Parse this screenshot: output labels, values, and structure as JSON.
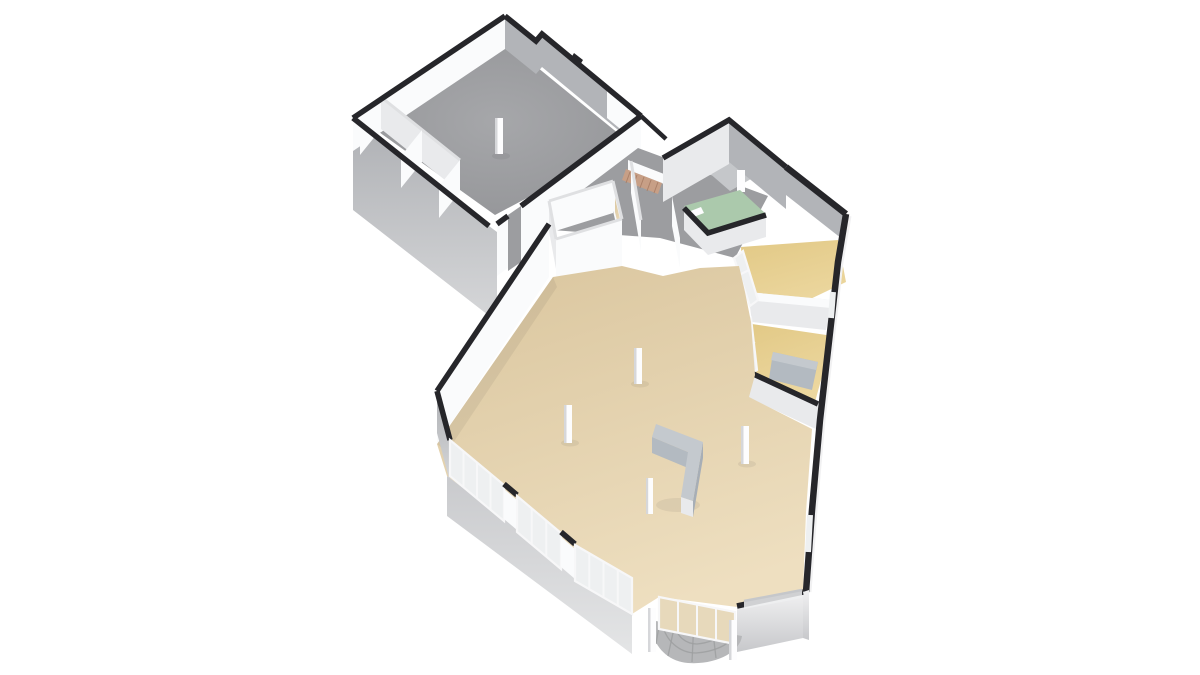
{
  "meta": {
    "kind": "3d-floorplan-render",
    "view": "isometric-birdseye",
    "background": "#ffffff",
    "visible_text": ""
  },
  "colors": {
    "bg": "#ffffff",
    "wallCap": "#26262a",
    "capLight": "#dfe0e2",
    "frame": "#f7f7f8",
    "wallFaceLit": "#fafbfc",
    "wallFaceSoft": "#e9eaec",
    "wallFaceMid": "#c5c7ca",
    "wallFaceShadow": "#b2b4b8",
    "floorGray": "#9c9da0",
    "floorGrayLight": "#a6a7aa",
    "floorGrayDark": "#919295",
    "floorBeigeLight": "#eedfc0",
    "floorBeigeDark": "#dbc7a0",
    "floorGoldLight": "#ecd79f",
    "floorGoldDark": "#e2c986",
    "floorGreen": "#abc9ac",
    "glass": "#eef0f1",
    "glassTint": "#e7d9bb",
    "extTop": "#aeb0b4",
    "extBottom": "#d6d7d9",
    "extWhiteTop": "#f1f1f2",
    "extWhiteBottom": "#c7c8cb",
    "slabTop": "#c9cacd",
    "slabBottom": "#e4e5e6",
    "porchTile": "#b6b7b9",
    "porchGrout": "#9c9d9f",
    "stairSalmon": "#c79f86",
    "stairTread": "#ab8169",
    "counterTop": "#c4c9ce",
    "counterSide": "#a7aeb6",
    "counterSide2": "#b3bac1",
    "columnWhite": "#fdfdfe",
    "columnShade": "#d6d7da"
  },
  "scene": {
    "building": "single-storey commercial unit, 3D dollhouse cutaway",
    "rooms": [
      {
        "name": "large-gray-hall",
        "floor": "floorGray",
        "features": [
          "one-column",
          "three-storage-cubicles"
        ]
      },
      {
        "name": "corridor-rooms",
        "floor": "floorGray",
        "features": [
          "staircase-salmon",
          "doorway-openings"
        ]
      },
      {
        "name": "entrance-vestibule",
        "floor": "floorGray",
        "features": [
          "protruding-block"
        ]
      },
      {
        "name": "green-room",
        "floor": "floorGreen",
        "features": [
          "door-leaf"
        ]
      },
      {
        "name": "gold-room-1",
        "floor": "floorGold",
        "features": [
          "glass-partition"
        ]
      },
      {
        "name": "gold-room-2",
        "floor": "floorGold",
        "features": [
          "glass-partition",
          "gray-cabinet"
        ]
      },
      {
        "name": "main-beige-hall",
        "floor": "floorBeige",
        "features": [
          "three-columns",
          "l-shaped-counter",
          "storefront-glazing",
          "entrance-doors",
          "curved-entry-steps",
          "interior-railing"
        ]
      }
    ],
    "counts": {
      "columns_total": 5,
      "storefront_glazing_runs": 3,
      "entry_door_panes": 4,
      "gold_rooms": 2
    }
  }
}
